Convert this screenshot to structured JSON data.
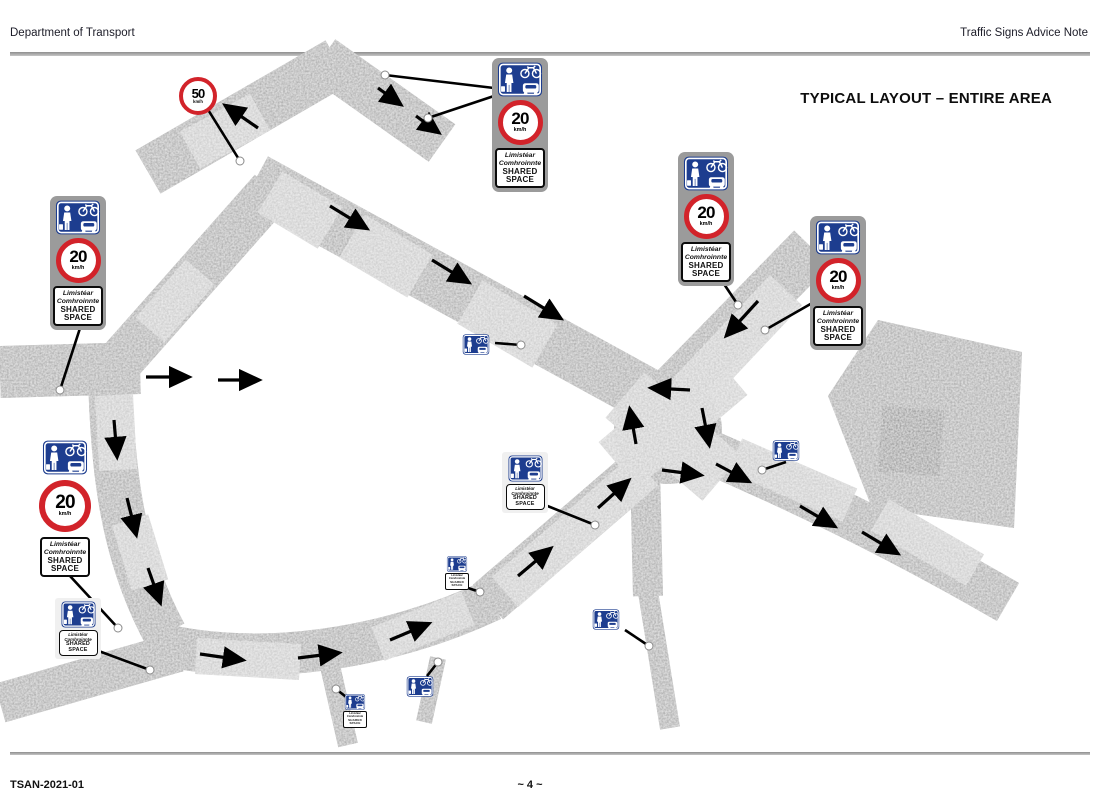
{
  "header": {
    "left": "Department of Transport",
    "right": "Traffic Signs Advice Note"
  },
  "title": "TYPICAL LAYOUT – ENTIRE AREA",
  "footer": {
    "doc_ref": "TSAN-2021-01",
    "page": "~ 4 ~"
  },
  "signs": {
    "shared_space_regulatory": {
      "speed_limit": {
        "value": "20",
        "unit": "km/h"
      },
      "plaque": {
        "irish_line1": "Limistéar",
        "irish_line2": "Comhroinnte",
        "english_line1": "SHARED",
        "english_line2": "SPACE"
      }
    },
    "speed_limit_50": {
      "value": "50",
      "unit": "km/h"
    },
    "icons": {
      "pedestrian": "pedestrian-icon",
      "bicycle": "bicycle-icon",
      "car": "car-icon"
    }
  },
  "colors": {
    "sign_red": "#d2232a",
    "sign_blue": "#1d3d8f",
    "road_grey": "#a2a2a2",
    "panel_grey": "#9b9b9b"
  }
}
